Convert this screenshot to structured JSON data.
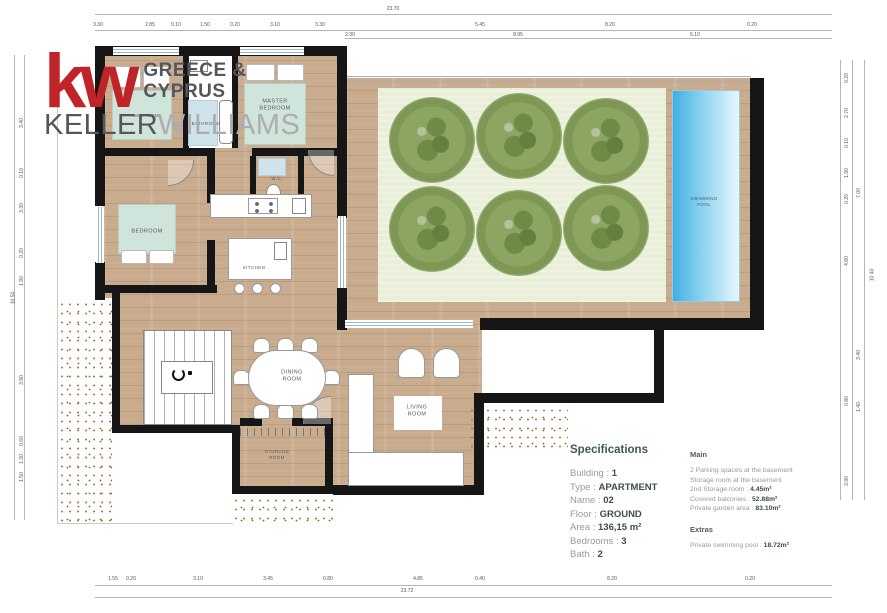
{
  "logo": {
    "kw": "kw",
    "region": "GREECE &\nCYPRUS",
    "brand_first": "KELLER",
    "brand_second": "WILLIAMS",
    "red": "#bf2428",
    "dark_gray": "#55565a",
    "light_gray": "#abadaf"
  },
  "plan": {
    "labels": {
      "master_bedroom": "MASTER\nBEDROOM",
      "bedroom_top": "BEDROOM",
      "bathroom": "BATHROOM",
      "bedroom": "BEDROOM",
      "wc": "W.C.",
      "kitchen": "KITCHEN",
      "dining_room": "DINING\nROOM",
      "living_room": "LIVING\nROOM",
      "storage_room": "STORAGE\nROOM",
      "swimming_pool": "SWIMMING\nPOOL"
    },
    "colors": {
      "wood": "#c9ab8e",
      "garden_green": "#e9efd8",
      "tree_green": "#7e9754",
      "pool_blue": "#45b4e6",
      "bed_mint": "#cfe4da",
      "tile_blue": "#cfe3ea",
      "wall": "#161616"
    }
  },
  "specifications": {
    "title": "Specifications",
    "items": [
      {
        "label": "Building : ",
        "value": "1"
      },
      {
        "label": "Type : ",
        "value": "APARTMENT"
      },
      {
        "label": "Name : ",
        "value": "02"
      },
      {
        "label": "Floor : ",
        "value": "GROUND"
      },
      {
        "label": "Area : ",
        "value": "136,15 m²"
      },
      {
        "label": "Bedrooms : ",
        "value": "3"
      },
      {
        "label": "Bath : ",
        "value": "2"
      }
    ]
  },
  "details": {
    "main_title": "Main",
    "main_items": [
      {
        "label": "2 Parking spaces at the basement",
        "value": ""
      },
      {
        "label": "Storage room at the basement",
        "value": ""
      },
      {
        "label": "2nd Storage room : ",
        "value": "4.45m²"
      },
      {
        "label": "Covered balconies : ",
        "value": "52.88m²"
      },
      {
        "label": "Private garden area : ",
        "value": "83.10m²"
      }
    ],
    "extras_title": "Extras",
    "extras_items": [
      {
        "label": "Private swimming pool : ",
        "value": "18.72m²"
      }
    ]
  },
  "dimensions": {
    "top_overall": [
      {
        "text": "23.70",
        "x": 393
      }
    ],
    "top_segments": [
      {
        "text": "3.30",
        "x": 98
      },
      {
        "text": "2.85",
        "x": 150
      },
      {
        "text": "0.10",
        "x": 176
      },
      {
        "text": "1.50",
        "x": 205
      },
      {
        "text": "0.20",
        "x": 235
      },
      {
        "text": "3.10",
        "x": 275
      },
      {
        "text": "3.30",
        "x": 320
      },
      {
        "text": "5.45",
        "x": 480
      },
      {
        "text": "8.20",
        "x": 610
      },
      {
        "text": "0.20",
        "x": 752
      }
    ],
    "top_tier2": [
      {
        "text": "2.30",
        "x": 350
      },
      {
        "text": "8.95",
        "x": 518
      },
      {
        "text": "5.10",
        "x": 695
      }
    ],
    "bottom_segments": [
      {
        "text": "1.55",
        "x": 113
      },
      {
        "text": "0.20",
        "x": 131
      },
      {
        "text": "3.10",
        "x": 198
      },
      {
        "text": "3.45",
        "x": 268
      },
      {
        "text": "0.80",
        "x": 328
      },
      {
        "text": "4.85",
        "x": 418
      },
      {
        "text": "0.40",
        "x": 480
      },
      {
        "text": "8.20",
        "x": 612
      },
      {
        "text": "0.20",
        "x": 750
      }
    ],
    "bottom_overall": [
      {
        "text": "23.72",
        "x": 407
      }
    ],
    "left_segments": [
      {
        "text": "3.40",
        "y": 120
      },
      {
        "text": "0.10",
        "y": 170
      },
      {
        "text": "3.30",
        "y": 205
      },
      {
        "text": "0.20",
        "y": 250
      },
      {
        "text": "1.90",
        "y": 278
      },
      {
        "text": "3.90",
        "y": 377
      },
      {
        "text": "0.60",
        "y": 438
      },
      {
        "text": "1.30",
        "y": 456
      },
      {
        "text": "1.50",
        "y": 474
      }
    ],
    "left_overall": [
      {
        "text": "10.50",
        "y": 295
      }
    ],
    "right_segments": [
      {
        "text": "0.20",
        "y": 75
      },
      {
        "text": "2.70",
        "y": 110
      },
      {
        "text": "0.10",
        "y": 140
      },
      {
        "text": "1.90",
        "y": 170
      },
      {
        "text": "0.20",
        "y": 196
      },
      {
        "text": "4.80",
        "y": 258
      },
      {
        "text": "0.80",
        "y": 398
      },
      {
        "text": "3.90",
        "y": 478
      }
    ],
    "right_tier2": [
      {
        "text": "7.00",
        "y": 190
      },
      {
        "text": "3.40",
        "y": 352
      },
      {
        "text": "1.40",
        "y": 404
      }
    ],
    "right_overall": [
      {
        "text": "10.40",
        "y": 272
      }
    ]
  }
}
